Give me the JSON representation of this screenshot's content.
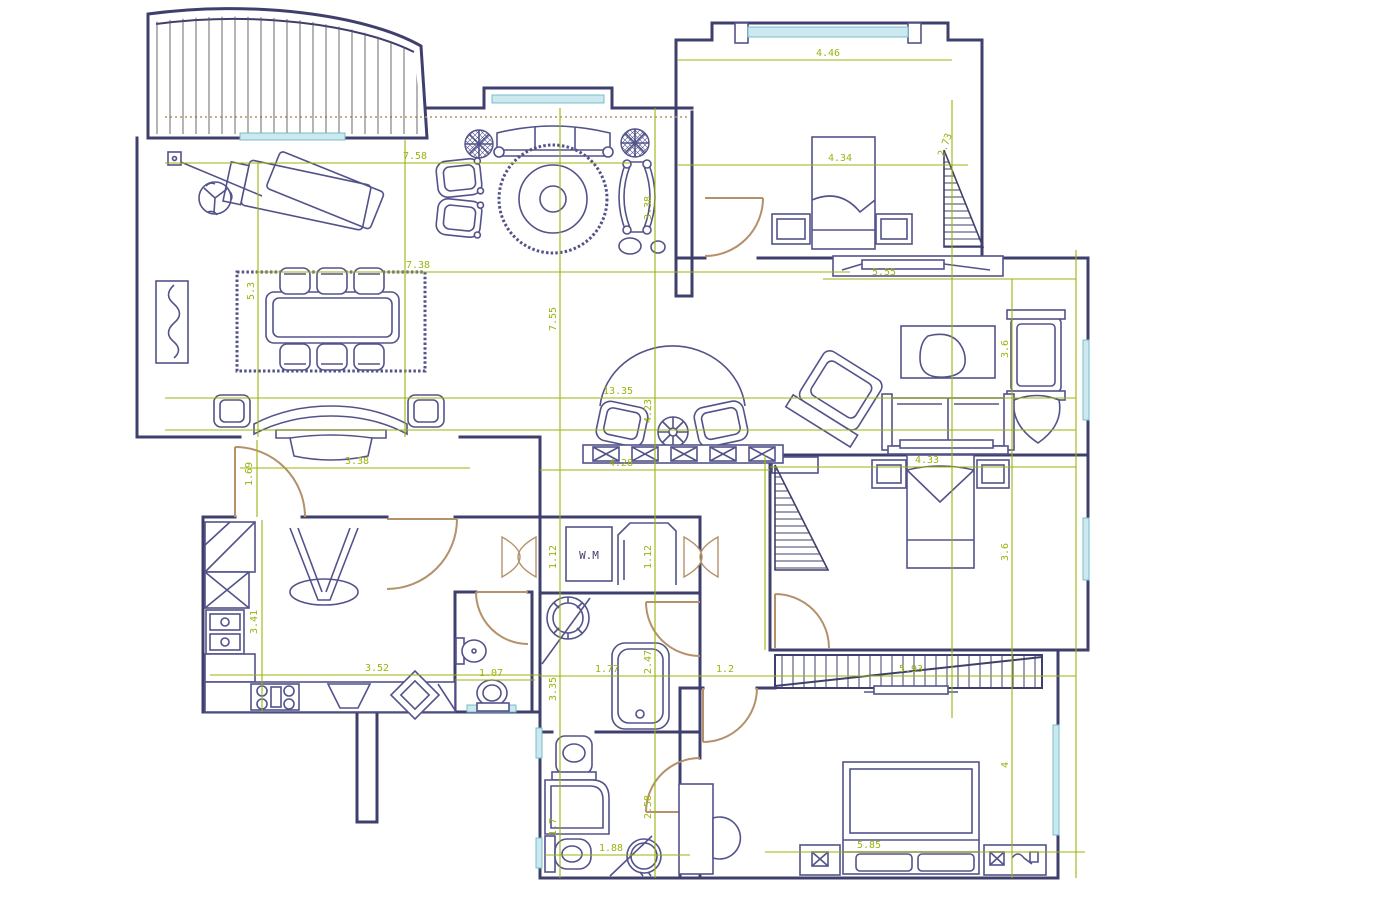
{
  "drawing": {
    "kind": "architectural-floor-plan",
    "units": "meters"
  },
  "colors": {
    "wall": "#3f3f6d",
    "furniture": "#53538b",
    "dimension": "#9cb30e",
    "door": "#b5916b",
    "window_fill": "#cbe9ee",
    "window_line": "#7abccb",
    "background": "#ffffff"
  },
  "labels": {
    "washing_machine": "W.M"
  },
  "dims": {
    "d1": "7.58",
    "d2": "7.38",
    "d3": "5.3",
    "d4": "4.46",
    "d5": "4.34",
    "d6": "2.73",
    "d7": "3.38",
    "d8": "5.55",
    "d9": "7.55",
    "d10": "13.35",
    "d11": "4.23",
    "d12": "3.6",
    "d13": "1.69",
    "d14": "3.38",
    "d15": "4.28",
    "d16": "4.33",
    "d17": "1.12",
    "d19": "1.12",
    "d20": "3.6",
    "d21": "3.41",
    "d22": "3.52",
    "d23": "1.07",
    "d24": "3.35",
    "d25": "1.77",
    "d26": "2.47",
    "d27": "1.2",
    "d28": "5.93",
    "d29": "1.7",
    "d30": "2.58",
    "d31": "1.88",
    "d32": "5.85",
    "d33": "4"
  }
}
